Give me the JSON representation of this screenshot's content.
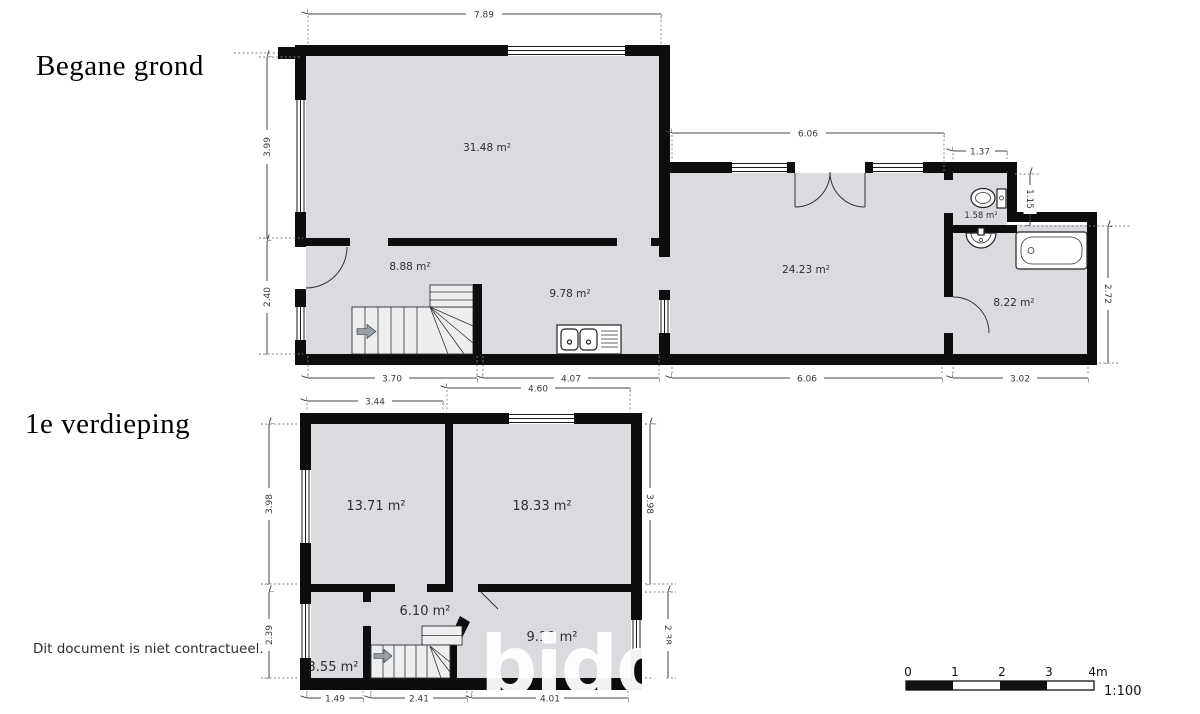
{
  "ground_floor": {
    "title": "Begane grond",
    "rooms": {
      "living": "31.48 m²",
      "hall": "8.88 m²",
      "kitchen": "9.78 m²",
      "family": "24.23 m²",
      "wc": "1.58 m²",
      "bathroom": "8.22 m²"
    },
    "dims": {
      "top": "7.89",
      "left_upper": "3.99",
      "left_lower": "2.40",
      "wing_top": "6.06",
      "wc_top": "1.37",
      "wc_right": "1.15",
      "bath_right": "2.72",
      "bottom_hall": "3.70",
      "bottom_kitchen": "4.07",
      "bottom_family": "6.06",
      "bottom_bath": "3.02"
    }
  },
  "first_floor": {
    "title": "1e verdieping",
    "rooms": {
      "bedroom_left": "13.71 m²",
      "bedroom_right": "18.33 m²",
      "landing": "6.10 m²",
      "bedroom_back": "9.19 m²",
      "storage": "3.55 m²"
    },
    "dims": {
      "top_left": "3.44",
      "top_right": "4.60",
      "left_upper": "3.98",
      "left_lower": "2.39",
      "right_upper": "3.98",
      "right_lower": "2.38",
      "bottom_left": "1.49",
      "bottom_mid": "2.41",
      "bottom_right": "4.01"
    }
  },
  "footer": {
    "disclaimer": "Dit document is niet contractueel."
  },
  "scale_bar": {
    "ticks": [
      "0",
      "1",
      "2",
      "3",
      "4m"
    ],
    "ratio": "1:100"
  },
  "watermark": {
    "text": "bidd"
  },
  "colors": {
    "wall": "#0d0d0d",
    "floor": "#d9dbde",
    "dimension": "#3a3a3a",
    "fixture_outline": "#222222",
    "direction_arrow": "#97a0a4",
    "watermark": "#ffffff",
    "background": "#ffffff"
  }
}
